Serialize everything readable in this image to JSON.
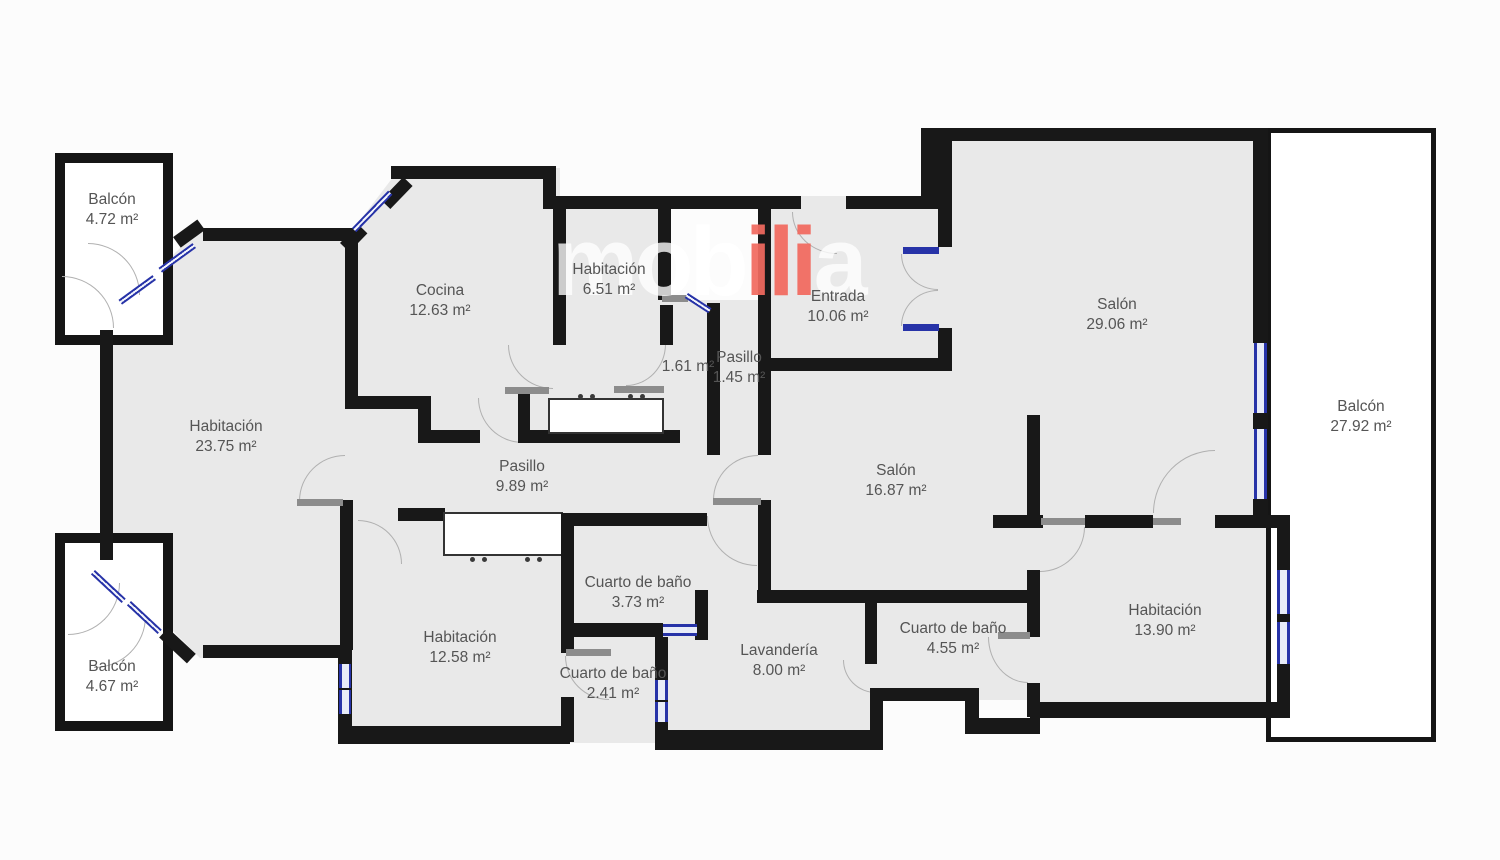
{
  "title": "floor-plan",
  "watermark": {
    "part1": "mob",
    "part2": "ili",
    "part3": "a",
    "red": "#f26a5f",
    "light": "#ececec"
  },
  "colors": {
    "wall": "#181818",
    "floor": "#e9e9e9",
    "window_frame": "#2733a8",
    "door_arc": "#b0b0b0",
    "label_text": "#555555"
  },
  "rooms": [
    {
      "id": "balcon-top-left",
      "name": "Balcón",
      "area": "4.72 m²"
    },
    {
      "id": "cocina",
      "name": "Cocina",
      "area": "12.63 m²"
    },
    {
      "id": "habitacion-651",
      "name": "Habitación",
      "area": "6.51 m²"
    },
    {
      "id": "entrada",
      "name": "Entrada",
      "area": "10.06 m²"
    },
    {
      "id": "salon-2906",
      "name": "Salón",
      "area": "29.06 m²"
    },
    {
      "id": "balcon-right",
      "name": "Balcón",
      "area": "27.92 m²"
    },
    {
      "id": "habitacion-2375",
      "name": "Habitación",
      "area": "23.75 m²"
    },
    {
      "id": "pasillo-989",
      "name": "Pasillo",
      "area": "9.89 m²"
    },
    {
      "id": "pasillo-161",
      "name": "",
      "area": "1.61 m²"
    },
    {
      "id": "pasillo-145",
      "name": "Pasillo",
      "area": "1.45 m²"
    },
    {
      "id": "salon-1687",
      "name": "Salón",
      "area": "16.87 m²"
    },
    {
      "id": "cuarto-bano-373",
      "name": "Cuarto de baño",
      "area": "3.73 m²"
    },
    {
      "id": "habitacion-1258",
      "name": "Habitación",
      "area": "12.58 m²"
    },
    {
      "id": "cuarto-bano-241",
      "name": "Cuarto de baño",
      "area": "2.41 m²"
    },
    {
      "id": "lavanderia",
      "name": "Lavandería",
      "area": "8.00 m²"
    },
    {
      "id": "cuarto-bano-455",
      "name": "Cuarto de baño",
      "area": "4.55 m²"
    },
    {
      "id": "habitacion-1390",
      "name": "Habitación",
      "area": "13.90 m²"
    },
    {
      "id": "balcon-bottom-left",
      "name": "Balcón",
      "area": "4.67 m²"
    }
  ]
}
